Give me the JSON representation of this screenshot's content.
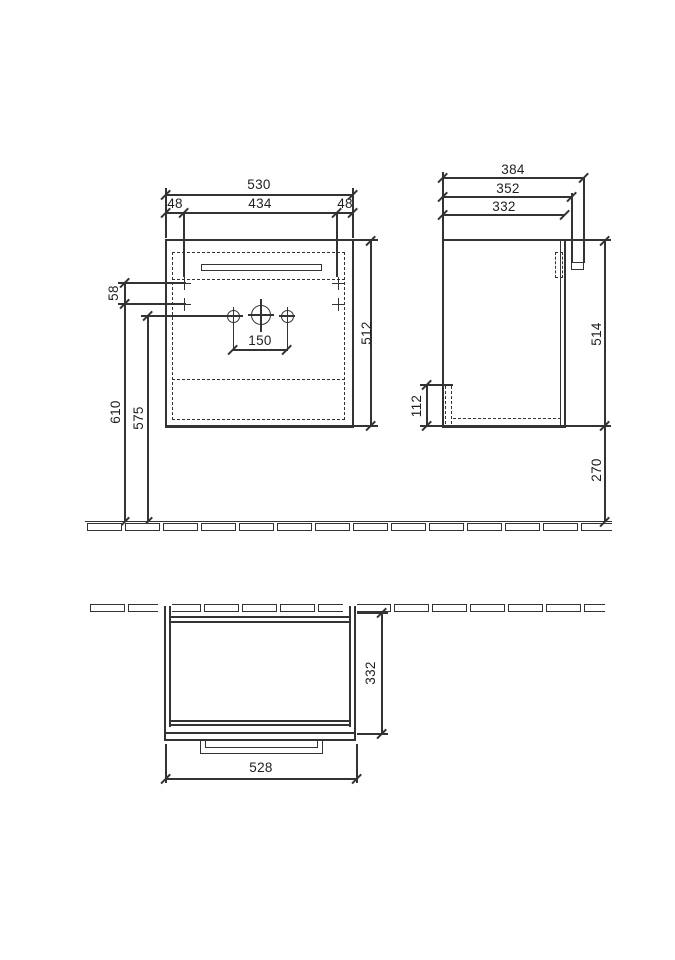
{
  "front_view": {
    "width_total": "530",
    "offset_left": "48",
    "width_inner": "434",
    "offset_right": "48",
    "height": "512",
    "hole_spacing": "150",
    "mount_gap": "58",
    "mount_height": "610",
    "hole_height": "575"
  },
  "side_view": {
    "depth_total": "384",
    "depth_rail": "352",
    "depth_body": "332",
    "height": "514",
    "recess_height": "112",
    "floor_clearance": "270"
  },
  "plan_view": {
    "depth": "332",
    "width": "528"
  }
}
